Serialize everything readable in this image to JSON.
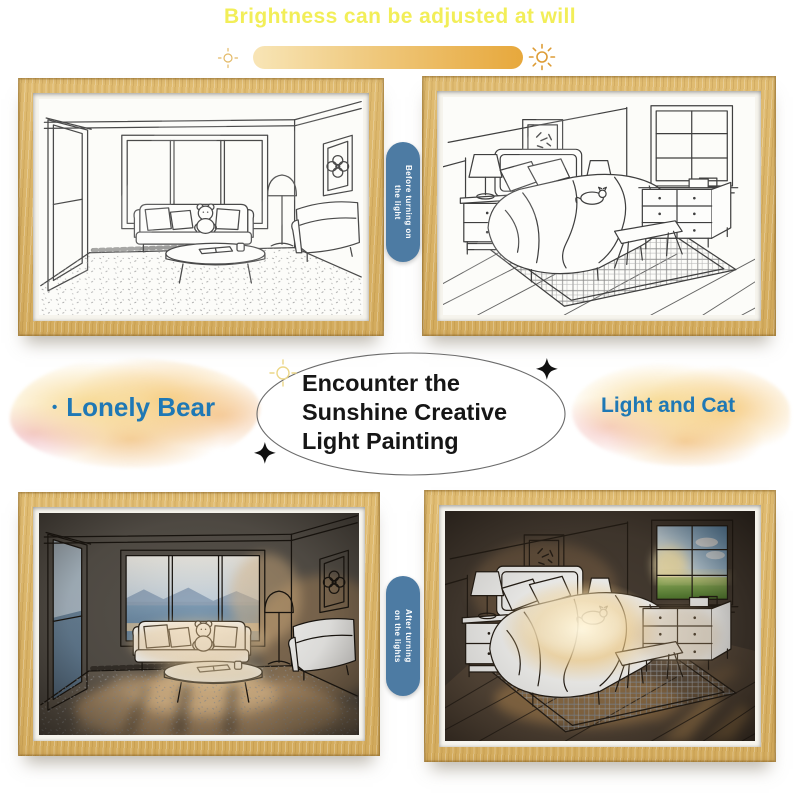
{
  "canvas": {
    "background": "#ffffff"
  },
  "header": {
    "title": "Brightness can be adjusted at will",
    "title_color": "#f2ee58",
    "slider": {
      "gradient_start": "#f8e5b6",
      "gradient_end": "#e7a83c"
    },
    "dim_sun_icon": "dim-sun",
    "bright_sun_icon": "bright-sun"
  },
  "ribbons": {
    "before": {
      "line1": "Before turning on",
      "line2": "the light",
      "background": "#4d7ba3",
      "text_color": "#ffffff"
    },
    "after": {
      "line1": "After turning",
      "line2": "on the lights",
      "background": "#4d7ba3",
      "text_color": "#ffffff"
    }
  },
  "center": {
    "heading_lines": [
      "Encounter the",
      "Sunshine Creative",
      "Light Painting"
    ],
    "heading_color": "#161616",
    "left_product": {
      "bullet": "•",
      "label": "Lonely Bear",
      "color": "#1f78b5"
    },
    "right_product": {
      "label": "Light and Cat",
      "color": "#1f78b5"
    }
  },
  "frames": {
    "wood_color": "#d9b266",
    "top_left": {
      "scene": "living-room-line-art"
    },
    "top_right": {
      "scene": "bedroom-line-art"
    },
    "bottom_left": {
      "scene": "living-room-illuminated"
    },
    "bottom_right": {
      "scene": "bedroom-illuminated"
    }
  }
}
